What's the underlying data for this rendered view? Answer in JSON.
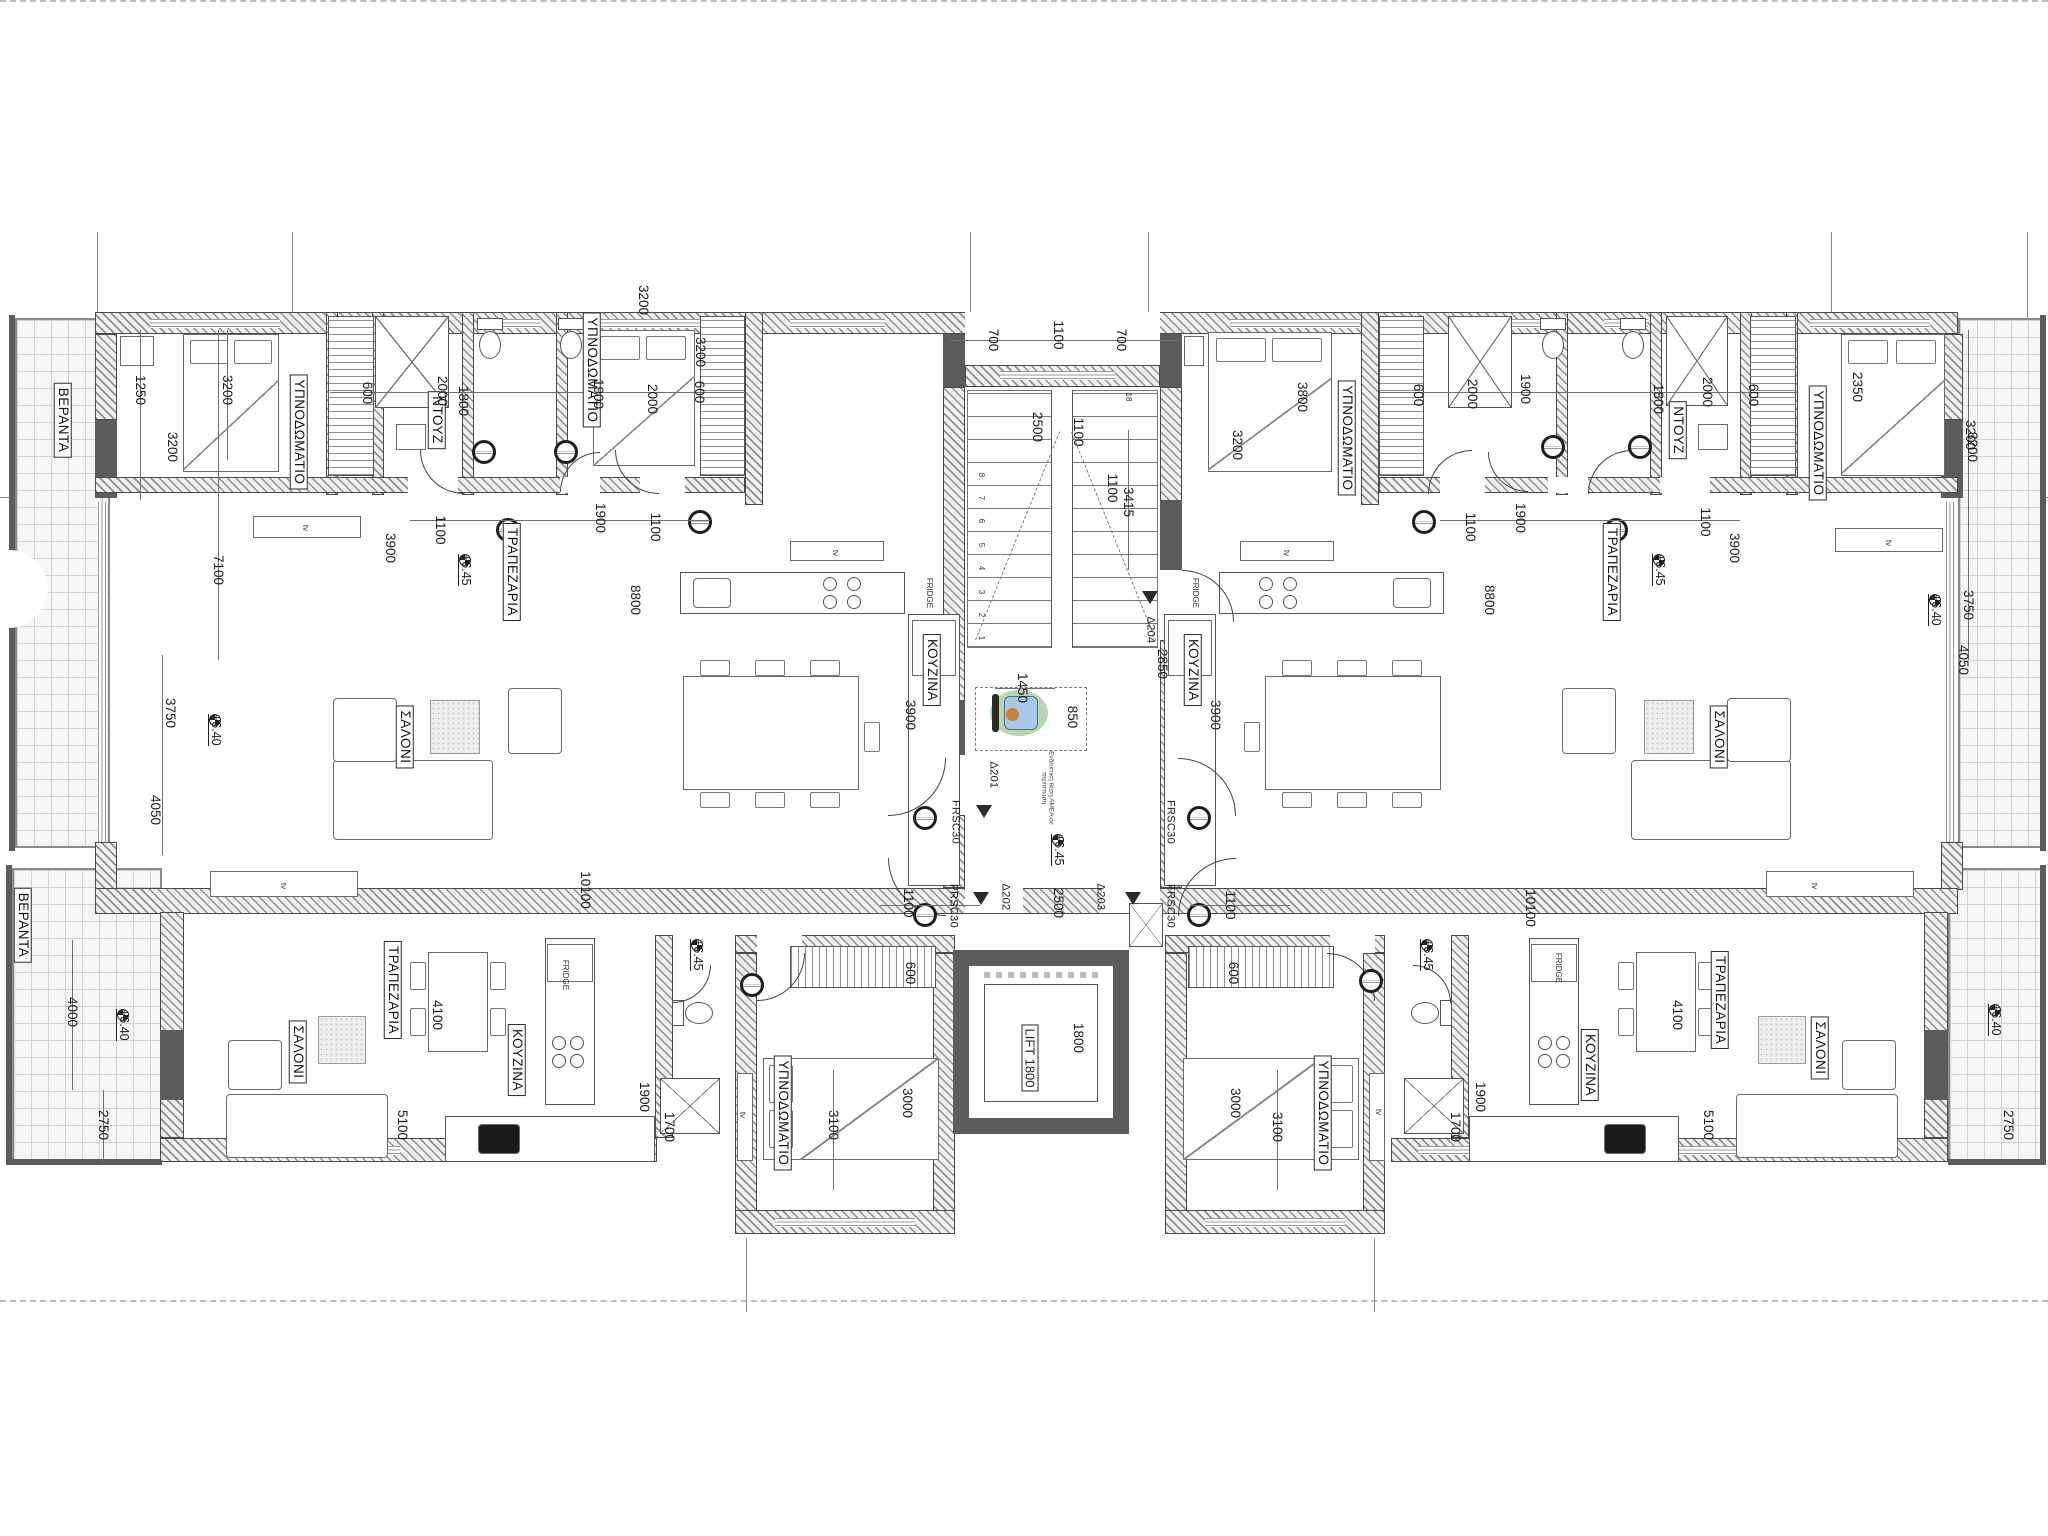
{
  "meta": {
    "drawing_type": "apartment building floor plan",
    "language": "Greek",
    "note_amea": "Ενδεικτική θέση ΑΜΕΑ σε περίπτωση"
  },
  "colors": {
    "wall_dark": "#5c5c5c",
    "hatch": "#8f8f8f",
    "wheelchair_green": "#b9d4b4",
    "wheelchair_blue": "#a9c7e6",
    "wheelchair_orange": "#c8803c"
  },
  "room_labels": [
    {
      "t": "ΒΕΡΑΝΤΑ",
      "x": 63,
      "y": 420
    },
    {
      "t": "ΒΕΡΑΝΤΑ",
      "x": 23,
      "y": 925
    },
    {
      "t": "ΥΠΝΟΔΩΜΑΤΙΟ",
      "x": 299,
      "y": 432
    },
    {
      "t": "ΥΠΝΟΔΩΜΑΤΙΟ",
      "x": 592,
      "y": 370
    },
    {
      "t": "ΥΠΝΟΔΩΜΑΤΙΟ",
      "x": 1347,
      "y": 438
    },
    {
      "t": "ΥΠΝΟΔΩΜΑΤΙΟ",
      "x": 1818,
      "y": 443
    },
    {
      "t": "ΥΠΝΟΔΩΜΑΤΙΟ",
      "x": 783,
      "y": 1113
    },
    {
      "t": "ΥΠΝΟΔΩΜΑΤΙΟ",
      "x": 1323,
      "y": 1113
    },
    {
      "t": "ΝΤΟΥΖ",
      "x": 437,
      "y": 420
    },
    {
      "t": "ΝΤΟΥΖ",
      "x": 1678,
      "y": 430
    },
    {
      "t": "ΣΑΛΟΝΙ",
      "x": 405,
      "y": 737
    },
    {
      "t": "ΣΑΛΟΝΙ",
      "x": 1719,
      "y": 737
    },
    {
      "t": "ΣΑΛΟΝΙ",
      "x": 298,
      "y": 1052
    },
    {
      "t": "ΣΑΛΟΝΙ",
      "x": 1820,
      "y": 1048
    },
    {
      "t": "ΤΡΑΠΕΖΑΡΙΑ",
      "x": 512,
      "y": 572
    },
    {
      "t": "ΤΡΑΠΕΖΑΡΙΑ",
      "x": 1612,
      "y": 572
    },
    {
      "t": "ΤΡΑΠΕΖΑΡΙΑ",
      "x": 393,
      "y": 990
    },
    {
      "t": "ΤΡΑΠΕΖΑΡΙΑ",
      "x": 1720,
      "y": 1000
    },
    {
      "t": "ΚΟΥΖΙΝΑ",
      "x": 932,
      "y": 670
    },
    {
      "t": "ΚΟΥΖΙΝΑ",
      "x": 1193,
      "y": 670
    },
    {
      "t": "ΚΟΥΖΙΝΑ",
      "x": 517,
      "y": 1060
    },
    {
      "t": "ΚΟΥΖΙΝΑ",
      "x": 1590,
      "y": 1065
    }
  ],
  "lift_label": {
    "t": "LIFT 1800",
    "x": 1030,
    "y": 1058
  },
  "dim_labels": [
    {
      "t": "1250",
      "x": 140,
      "y": 390
    },
    {
      "t": "7100",
      "x": 218,
      "y": 570
    },
    {
      "t": "3200",
      "x": 227,
      "y": 390
    },
    {
      "t": "3200",
      "x": 172,
      "y": 447
    },
    {
      "t": "600",
      "x": 367,
      "y": 393
    },
    {
      "t": "2000",
      "x": 442,
      "y": 391
    },
    {
      "t": "1800",
      "x": 463,
      "y": 401
    },
    {
      "t": "1900",
      "x": 598,
      "y": 394
    },
    {
      "t": "2000",
      "x": 652,
      "y": 399
    },
    {
      "t": "600",
      "x": 699,
      "y": 392
    },
    {
      "t": "1100",
      "x": 440,
      "y": 530
    },
    {
      "t": "1900",
      "x": 600,
      "y": 518
    },
    {
      "t": "1100",
      "x": 655,
      "y": 527
    },
    {
      "t": "3200",
      "x": 643,
      "y": 300
    },
    {
      "t": "3200",
      "x": 700,
      "y": 352
    },
    {
      "t": "700",
      "x": 993,
      "y": 340
    },
    {
      "t": "1100",
      "x": 1058,
      "y": 335
    },
    {
      "t": "700",
      "x": 1121,
      "y": 340
    },
    {
      "t": "2500",
      "x": 1037,
      "y": 427
    },
    {
      "t": "1100",
      "x": 1078,
      "y": 432
    },
    {
      "t": "1100",
      "x": 1112,
      "y": 488
    },
    {
      "t": "3415",
      "x": 1128,
      "y": 502
    },
    {
      "t": "1450",
      "x": 1022,
      "y": 688
    },
    {
      "t": "850",
      "x": 1072,
      "y": 717
    },
    {
      "t": "2850",
      "x": 1162,
      "y": 664
    },
    {
      "t": "2500",
      "x": 1058,
      "y": 903
    },
    {
      "t": "1800",
      "x": 1078,
      "y": 1038
    },
    {
      "t": "3800",
      "x": 1302,
      "y": 397
    },
    {
      "t": "3200",
      "x": 1237,
      "y": 445
    },
    {
      "t": "600",
      "x": 1418,
      "y": 395
    },
    {
      "t": "2000",
      "x": 1472,
      "y": 394
    },
    {
      "t": "1900",
      "x": 1525,
      "y": 389
    },
    {
      "t": "1800",
      "x": 1658,
      "y": 399
    },
    {
      "t": "2000",
      "x": 1707,
      "y": 392
    },
    {
      "t": "600",
      "x": 1753,
      "y": 395
    },
    {
      "t": "2350",
      "x": 1857,
      "y": 387
    },
    {
      "t": "3200",
      "x": 1972,
      "y": 447
    },
    {
      "t": "1100",
      "x": 1470,
      "y": 527
    },
    {
      "t": "1900",
      "x": 1520,
      "y": 518
    },
    {
      "t": "1100",
      "x": 1705,
      "y": 522
    },
    {
      "t": "3750",
      "x": 170,
      "y": 713
    },
    {
      "t": "4050",
      "x": 155,
      "y": 810
    },
    {
      "t": "4000",
      "x": 72,
      "y": 1012
    },
    {
      "t": "2750",
      "x": 103,
      "y": 1125
    },
    {
      "t": "3200",
      "x": 1970,
      "y": 435
    },
    {
      "t": "3750",
      "x": 1968,
      "y": 605
    },
    {
      "t": "4050",
      "x": 1963,
      "y": 660
    },
    {
      "t": "2750",
      "x": 2008,
      "y": 1125
    },
    {
      "t": "10100",
      "x": 585,
      "y": 890
    },
    {
      "t": "10100",
      "x": 1530,
      "y": 908
    },
    {
      "t": "8800",
      "x": 635,
      "y": 600
    },
    {
      "t": "3900",
      "x": 390,
      "y": 548
    },
    {
      "t": "3900",
      "x": 910,
      "y": 715
    },
    {
      "t": "8800",
      "x": 1489,
      "y": 600
    },
    {
      "t": "3900",
      "x": 1734,
      "y": 548
    },
    {
      "t": "3900",
      "x": 1215,
      "y": 715
    },
    {
      "t": "4100",
      "x": 437,
      "y": 1015
    },
    {
      "t": "5100",
      "x": 402,
      "y": 1125
    },
    {
      "t": "4100",
      "x": 1677,
      "y": 1015
    },
    {
      "t": "5100",
      "x": 1708,
      "y": 1125
    },
    {
      "t": "1100",
      "x": 908,
      "y": 903
    },
    {
      "t": "600",
      "x": 910,
      "y": 973
    },
    {
      "t": "3000",
      "x": 907,
      "y": 1103
    },
    {
      "t": "3100",
      "x": 833,
      "y": 1125
    },
    {
      "t": "1100",
      "x": 1230,
      "y": 905
    },
    {
      "t": "600",
      "x": 1233,
      "y": 973
    },
    {
      "t": "3000",
      "x": 1235,
      "y": 1103
    },
    {
      "t": "3100",
      "x": 1277,
      "y": 1127
    },
    {
      "t": "1900",
      "x": 644,
      "y": 1097
    },
    {
      "t": "1700",
      "x": 669,
      "y": 1127
    },
    {
      "t": "1900",
      "x": 1480,
      "y": 1097
    },
    {
      "t": "1700",
      "x": 1455,
      "y": 1127
    }
  ],
  "door_tags": [
    {
      "t": "Δ201",
      "x": 993,
      "y": 775,
      "tx": 984,
      "ty": 812
    },
    {
      "t": "Δ202",
      "x": 1005,
      "y": 897,
      "tx": 981,
      "ty": 899
    },
    {
      "t": "Δ203",
      "x": 1100,
      "y": 897,
      "tx": 1133,
      "ty": 899
    },
    {
      "t": "Δ204",
      "x": 1150,
      "y": 630,
      "tx": 1150,
      "ty": 598
    }
  ],
  "fire_tags": [
    {
      "t": "FRSC30",
      "x": 955,
      "y": 822
    },
    {
      "t": "FRSC30",
      "x": 953,
      "y": 906
    },
    {
      "t": "FRSC30",
      "x": 1170,
      "y": 822
    },
    {
      "t": "FRSC30",
      "x": 1170,
      "y": 906
    }
  ],
  "level_markers": [
    {
      "t": "+6.40",
      "x": 215,
      "y": 720
    },
    {
      "t": "+6.40",
      "x": 1935,
      "y": 600
    },
    {
      "t": "+6.40",
      "x": 123,
      "y": 1015
    },
    {
      "t": "+6.40",
      "x": 1995,
      "y": 1010
    },
    {
      "t": "+6.45",
      "x": 465,
      "y": 560
    },
    {
      "t": "+6.45",
      "x": 1659,
      "y": 560
    },
    {
      "t": "+6.45",
      "x": 1058,
      "y": 840
    },
    {
      "t": "+6.45",
      "x": 697,
      "y": 945
    },
    {
      "t": "+6.45",
      "x": 1427,
      "y": 945
    }
  ],
  "tiny_labels": [
    {
      "t": "tv",
      "x": 305,
      "y": 528
    },
    {
      "t": "tv",
      "x": 835,
      "y": 553
    },
    {
      "t": "tv",
      "x": 1286,
      "y": 553
    },
    {
      "t": "tv",
      "x": 1888,
      "y": 543
    },
    {
      "t": "tv",
      "x": 283,
      "y": 886
    },
    {
      "t": "tv",
      "x": 1814,
      "y": 886
    },
    {
      "t": "tv",
      "x": 742,
      "y": 1115
    },
    {
      "t": "tv",
      "x": 1378,
      "y": 1112
    },
    {
      "t": "FRIDGE",
      "x": 929,
      "y": 593
    },
    {
      "t": "FRIDGE",
      "x": 1195,
      "y": 593
    },
    {
      "t": "FRIDGE",
      "x": 565,
      "y": 975
    },
    {
      "t": "FRIDGE",
      "x": 1558,
      "y": 968
    },
    {
      "t": "18",
      "x": 1128,
      "y": 397
    }
  ],
  "stair_numbers": [
    {
      "t": "1",
      "x": 981,
      "y": 638
    },
    {
      "t": "2",
      "x": 981,
      "y": 615
    },
    {
      "t": "3",
      "x": 981,
      "y": 592
    },
    {
      "t": "4",
      "x": 981,
      "y": 568
    },
    {
      "t": "5",
      "x": 981,
      "y": 545
    },
    {
      "t": "6",
      "x": 981,
      "y": 521
    },
    {
      "t": "7",
      "x": 981,
      "y": 498
    },
    {
      "t": "8",
      "x": 981,
      "y": 475
    }
  ]
}
